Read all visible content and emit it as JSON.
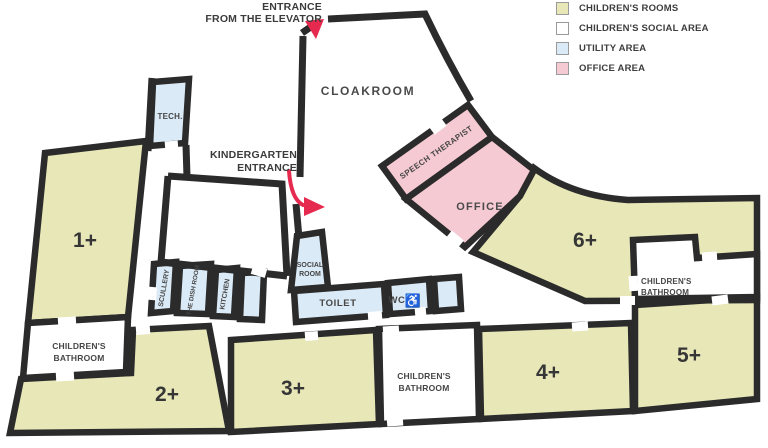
{
  "legend": {
    "items": [
      {
        "label": "CHILDREN'S ROOMS",
        "color": "#e7e7b8"
      },
      {
        "label": "CHILDREN'S SOCIAL AREA",
        "color": "#ffffff"
      },
      {
        "label": "UTILITY AREA",
        "color": "#daeaf6"
      },
      {
        "label": "OFFICE AREA",
        "color": "#f6cad3"
      }
    ]
  },
  "annotations": {
    "elevator_line1": "ENTRANCE",
    "elevator_line2": "FROM THE ELEVATOR",
    "kindergarten_line1": "KINDERGARTEN",
    "kindergarten_line2": "ENTRANCE"
  },
  "rooms": {
    "cloakroom": {
      "label": "CLOAKROOM"
    },
    "tech": {
      "label": "TECH."
    },
    "scullery": {
      "label": "SCULLERY"
    },
    "dish_room": {
      "label": "THE DISH ROOM"
    },
    "kitchen": {
      "label": "KITCHEN"
    },
    "social_room": {
      "line1": "SOCIAL",
      "line2": "ROOM"
    },
    "toilet": {
      "label": "TOILET"
    },
    "wc": {
      "label": "WC",
      "icon": "♿"
    },
    "speech_therapist": {
      "label": "SPEECH THERAPIST"
    },
    "office": {
      "label": "OFFICE"
    },
    "room_1": {
      "label": "1+"
    },
    "room_2": {
      "label": "2+"
    },
    "room_3": {
      "label": "3+"
    },
    "room_4": {
      "label": "4+"
    },
    "room_5": {
      "label": "5+"
    },
    "room_6": {
      "label": "6+"
    },
    "bath_left": {
      "line1": "CHILDREN'S",
      "line2": "BATHROOM"
    },
    "bath_mid": {
      "line1": "CHILDREN'S",
      "line2": "BATHROOM"
    },
    "bath_right": {
      "line1": "CHILDREN'S",
      "line2": "BATHROOM"
    }
  },
  "colors": {
    "wall": "#2b2b2b",
    "childrens_rooms": "#e7e7b8",
    "childrens_social": "#ffffff",
    "utility_area": "#daeaf6",
    "office_area": "#f6cad3",
    "arrow": "#e62a4f"
  }
}
